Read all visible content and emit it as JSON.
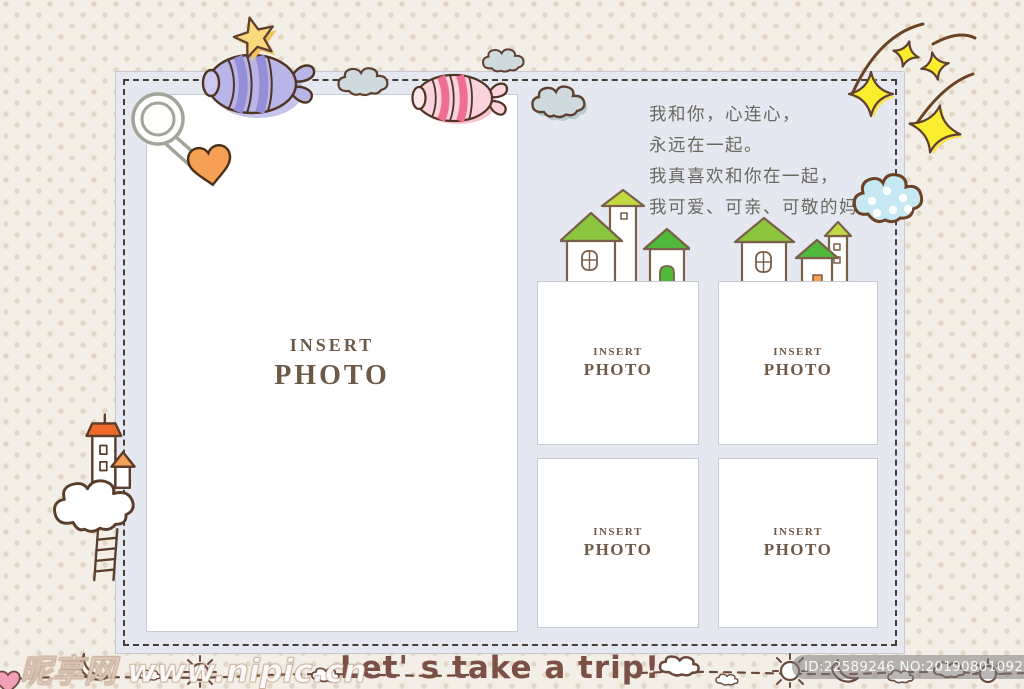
{
  "panel": {
    "name": "stitched photo panel"
  },
  "poem": {
    "lines": [
      "我和你，心连心，",
      "永远在一起。",
      "我真喜欢和你在一起，",
      "我可爱、可亲、可敬的妈妈。"
    ]
  },
  "placeholders": {
    "main": {
      "line1": "INSERT",
      "line2": "PHOTO"
    },
    "small": [
      {
        "line1": "INSERT",
        "line2": "PHOTO"
      },
      {
        "line1": "INSERT",
        "line2": "PHOTO"
      },
      {
        "line1": "INSERT",
        "line2": "PHOTO"
      },
      {
        "line1": "INSERT",
        "line2": "PHOTO"
      }
    ]
  },
  "footer": {
    "caption": "Let' s take a trip!",
    "watermark": "昵享网 www.nipic.cn",
    "stock_id": "ID:22589246 NO:20190801092747866083"
  },
  "colors": {
    "background": "#f4efe6",
    "background_dot": "#e3d6c4",
    "panel": "#e5e8f1",
    "stitch": "#2e2116",
    "photo_border": "#c7cad3",
    "placeholder_text": "#6d5946",
    "poem_text": "#6a6960",
    "caption_text": "#7b5046",
    "outline_brown": "#5f3b28",
    "candy_purple": "#b9b5e8",
    "candy_pink": "#fbd3dc",
    "candy_pink_stripe": "#f06e92",
    "star_yellow": "#fbd87b",
    "sparkle_yellow": "#f9ed2e",
    "roof_green": "#8cc63f",
    "roof_dark_green": "#50b93c",
    "roof_lime": "#c2d943",
    "roof_orange": "#f06a2e",
    "heart_orange": "#f5a055",
    "cloud_blue": "#c5e8f2",
    "cloud_gray": "#cfdade"
  },
  "icons": {
    "purple-candy-icon": "wrapped candy shape",
    "pink-candy-icon": "wrapped candy shape",
    "star-icon": "★",
    "sparkle-stars-icon": "✦✦✦ with trails",
    "cloud-icon": "☁",
    "dotted-cloud-icon": "☁ with dots",
    "safety-pin-icon": "pin with heart clasp",
    "lighthouse-icon": "tower on cloud with ladder",
    "houses-icon": "small roofed houses",
    "doodle-strip-icon": "dashed line with sun, moon, clouds"
  }
}
